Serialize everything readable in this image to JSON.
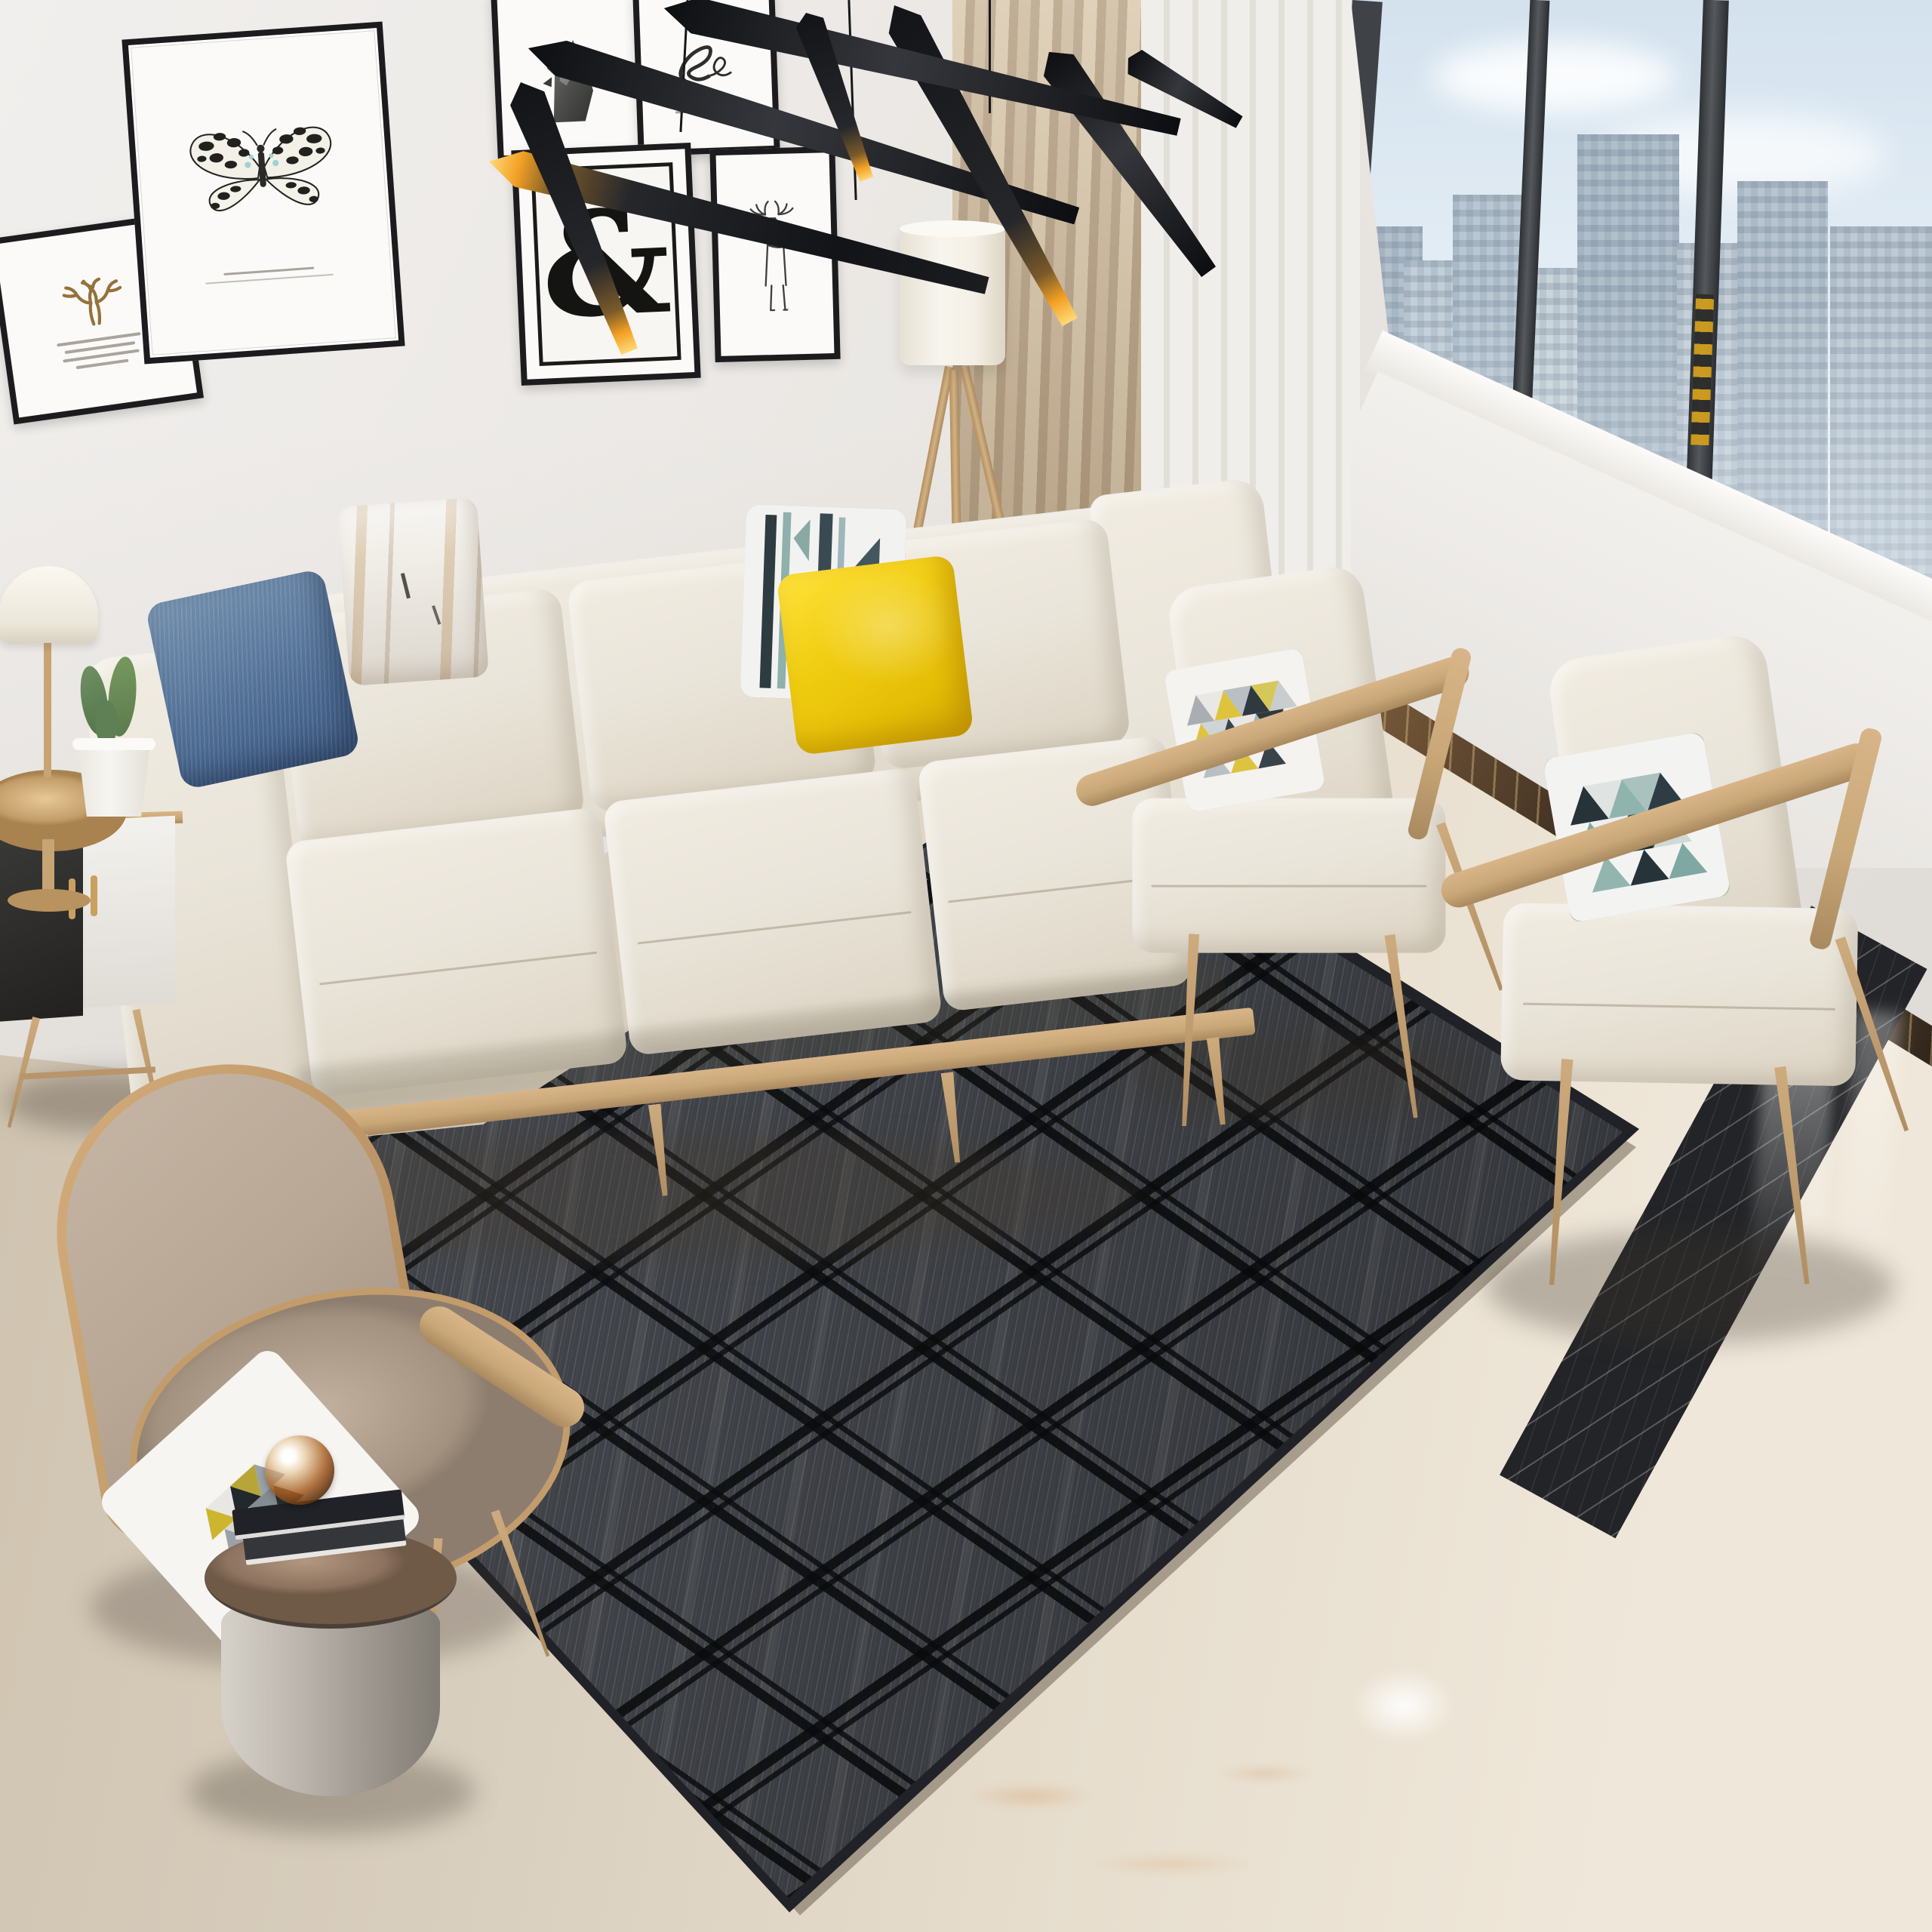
{
  "scene": {
    "label": "modern living room with charcoal diamond-lattice area rug",
    "kind": "interior product photograph"
  },
  "art": {
    "ampersand": "&"
  },
  "objects": [
    "gallery-wall-frames",
    "antler-print",
    "butterfly-print",
    "wolf-print",
    "script-print",
    "ampersand-print",
    "deer-print",
    "hanging-blade-mobile",
    "city-window",
    "beige-curtain",
    "white-panel-wall",
    "floor-lamp",
    "three-seat-sofa",
    "blue-pillow",
    "paint-stroke-pillow",
    "triangle-pillow",
    "yellow-pillow",
    "side-cabinet",
    "table-lamp",
    "cactus-pot",
    "armchair-left",
    "armchair-right",
    "diamond-rug",
    "shell-chair",
    "drum-side-table",
    "stacked-books",
    "glass-ball",
    "marble-skirting",
    "black-marble-band",
    "beige-marble-floor"
  ],
  "palette": {
    "wall": "#e9e6e2",
    "wallRight": "#f2f0ed",
    "floor": "#d9cfbf",
    "floorDark": "#c4b7a2",
    "rug": "#3e4147",
    "rugLine": "#141519",
    "rugEdge": "#202227",
    "sofa": "#eae5da",
    "sofaShade": "#d3cbbc",
    "wood": "#c9a878",
    "woodDark": "#a9895f",
    "curtain": "#cdb99c",
    "curtainDark": "#b29c7e",
    "lamp": "#f4f0e6",
    "sky": "#d4e2ee",
    "building": "#bac7d2",
    "mullion": "#393c40",
    "marbleGold": "#6a5136",
    "marbleBlack": "#232427",
    "blue": "#5c7a9e",
    "yellow": "#f0cd11",
    "teal": "#7fa8a2",
    "ink": "#1c1c1e",
    "leather": "#b9a795",
    "orange": "#f2a024"
  }
}
